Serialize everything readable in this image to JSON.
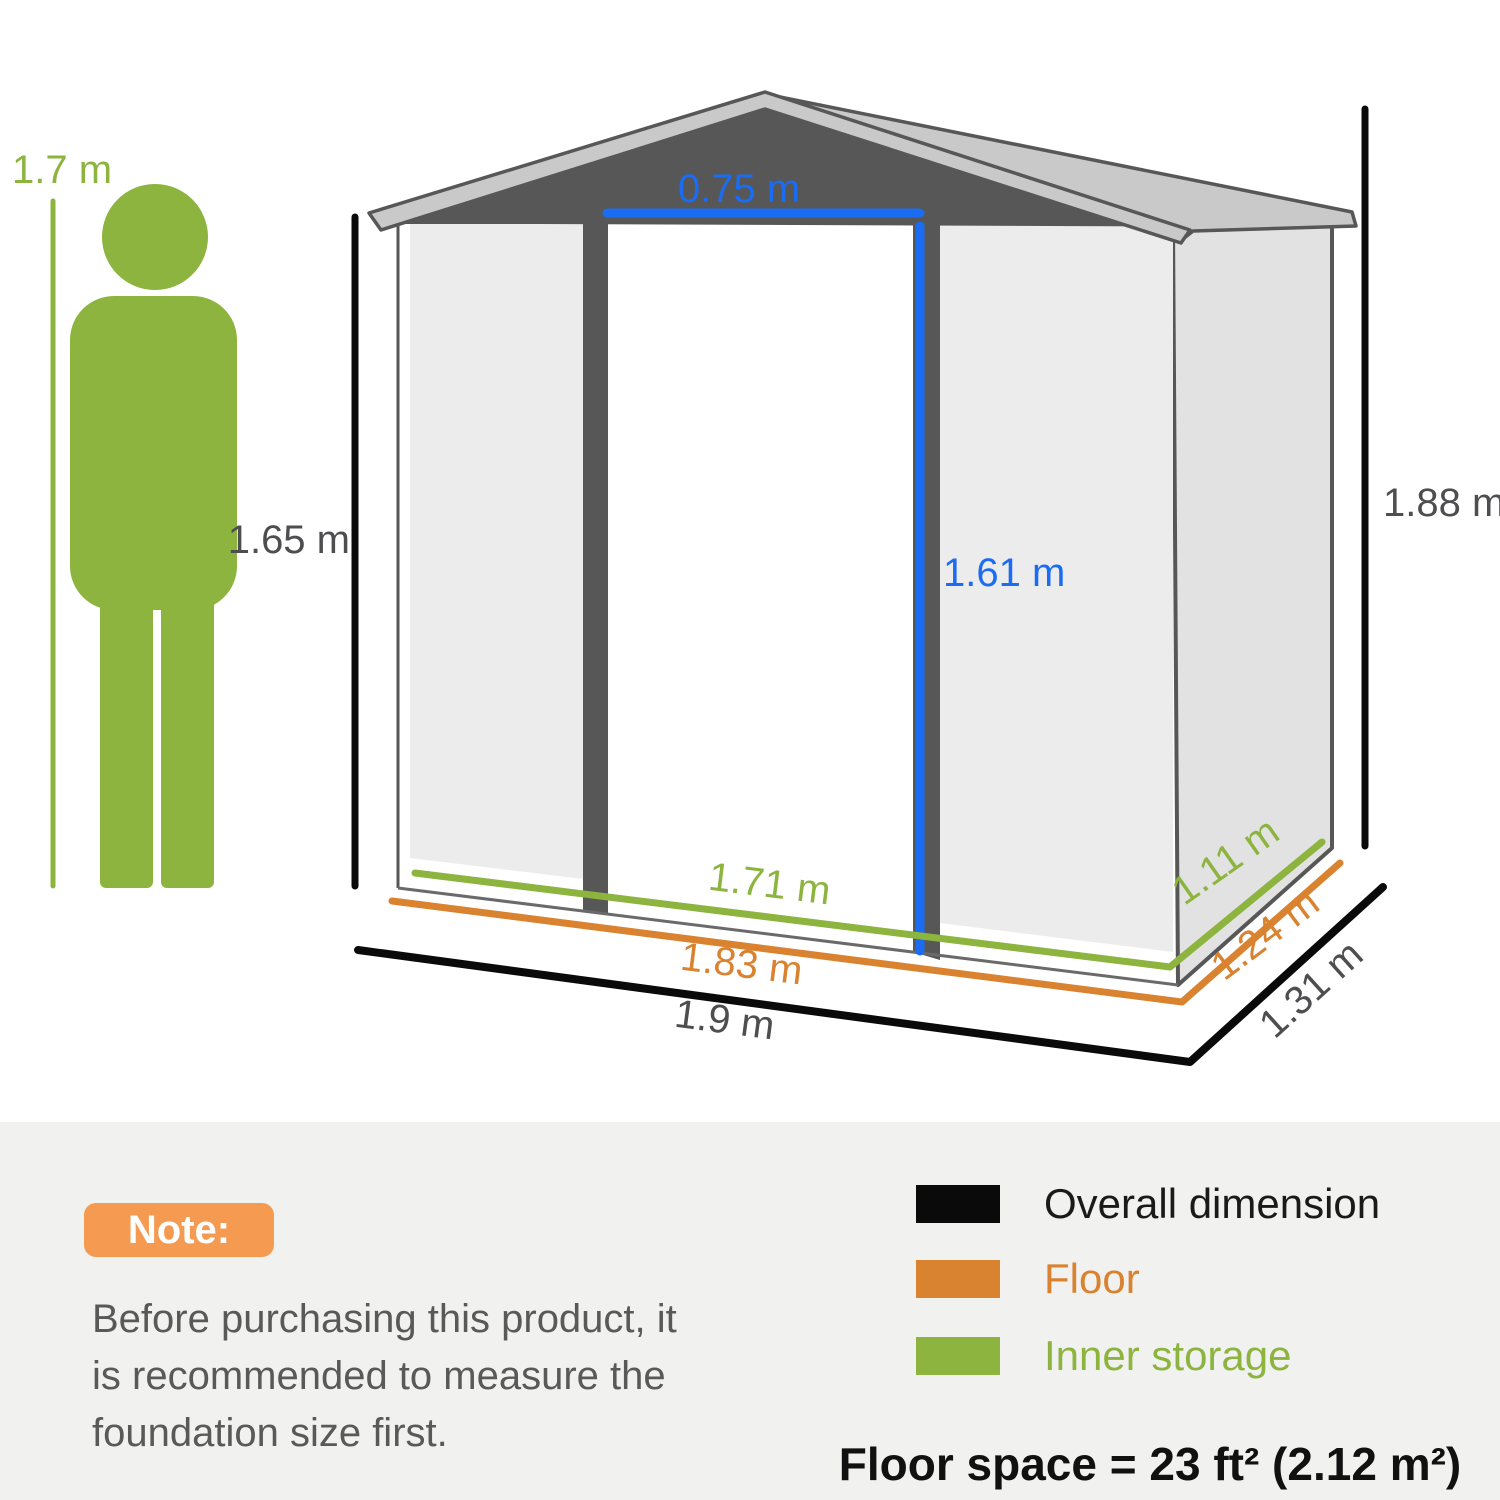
{
  "person": {
    "height_label": "1.7 m"
  },
  "shed": {
    "door_width": "0.75 m",
    "door_height": "1.61 m",
    "wall_height": "1.65 m",
    "overall_height": "1.88 m",
    "inner_width": "1.71 m",
    "floor_width": "1.83 m",
    "overall_width": "1.9 m",
    "inner_depth": "1.11 m",
    "floor_depth": "1.24 m",
    "overall_depth": "1.31 m"
  },
  "note": {
    "badge_label": "Note:",
    "lines": [
      "Before purchasing this product, it",
      "is recommended to measure the",
      "foundation size first."
    ]
  },
  "legend": {
    "items": [
      {
        "label": "Overall dimension",
        "color": "#0A0A0A"
      },
      {
        "label": "Floor",
        "color": "#D9822F"
      },
      {
        "label": "Inner storage",
        "color": "#8CB43E"
      }
    ],
    "floor_space_label": "Floor space = 23 ft² (2.12 m²)"
  },
  "colors": {
    "green": "#8CB43E",
    "orange": "#D9822F",
    "blue": "#1A6CF2",
    "black": "#0A0A0A",
    "dark_gray": "#575757",
    "roof_gray": "#C9C9C9",
    "panel_gray": "#ECECEC",
    "side_wall_gray": "#E2E2E2",
    "label_gray": "#4E4E50",
    "note_badge_orange": "#F59B51",
    "note_text_gray": "#595959",
    "section_bg": "#F1F1F0"
  }
}
